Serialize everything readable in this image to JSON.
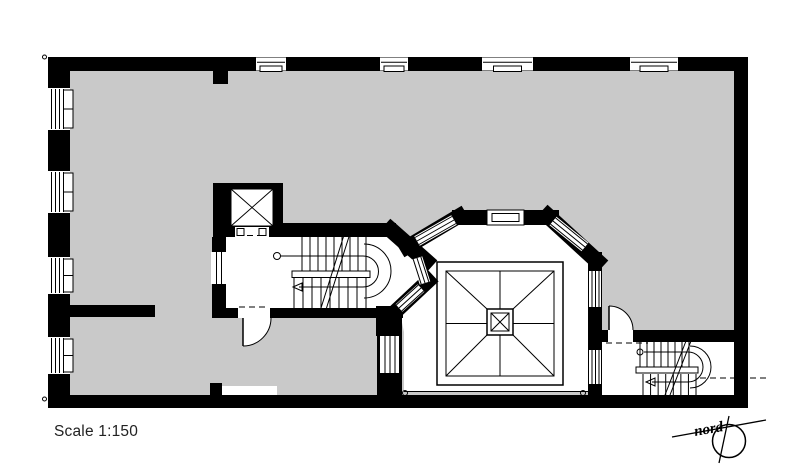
{
  "labels": {
    "scale": "Scale 1:150",
    "north": "nord"
  },
  "colors": {
    "wall": "#000000",
    "floor": "#c9c9c9",
    "background": "#ffffff",
    "line": "#000000"
  },
  "plan": {
    "type": "architectural-floor-plan",
    "features": [
      "elevator",
      "central-staircase",
      "southeast-staircase",
      "pyramid-skylight",
      "light-court-bay-windows",
      "north-arrow",
      "scale-label"
    ]
  },
  "windows": {
    "left_wall": [
      {
        "y": 88,
        "h": 42
      },
      {
        "y": 171,
        "h": 42
      },
      {
        "y": 257,
        "h": 37
      },
      {
        "y": 337,
        "h": 37
      }
    ],
    "top_wall": [
      {
        "x": 256,
        "w": 30
      },
      {
        "x": 380,
        "w": 28
      },
      {
        "x": 482,
        "w": 51
      },
      {
        "x": 630,
        "w": 48
      }
    ]
  },
  "stairs": {
    "central": {
      "flights": [
        {
          "x0": 302,
          "x1": 366,
          "n": 9,
          "y0": 237,
          "y1": 271
        },
        {
          "x0": 294,
          "x1": 366,
          "n": 9,
          "y0": 277,
          "y1": 308
        }
      ]
    },
    "southeast": {
      "flights": [
        {
          "x0": 640,
          "x1": 689,
          "n": 8,
          "y0": 342,
          "y1": 368
        },
        {
          "x0": 643,
          "x1": 696,
          "n": 8,
          "y0": 374,
          "y1": 396
        }
      ]
    }
  }
}
